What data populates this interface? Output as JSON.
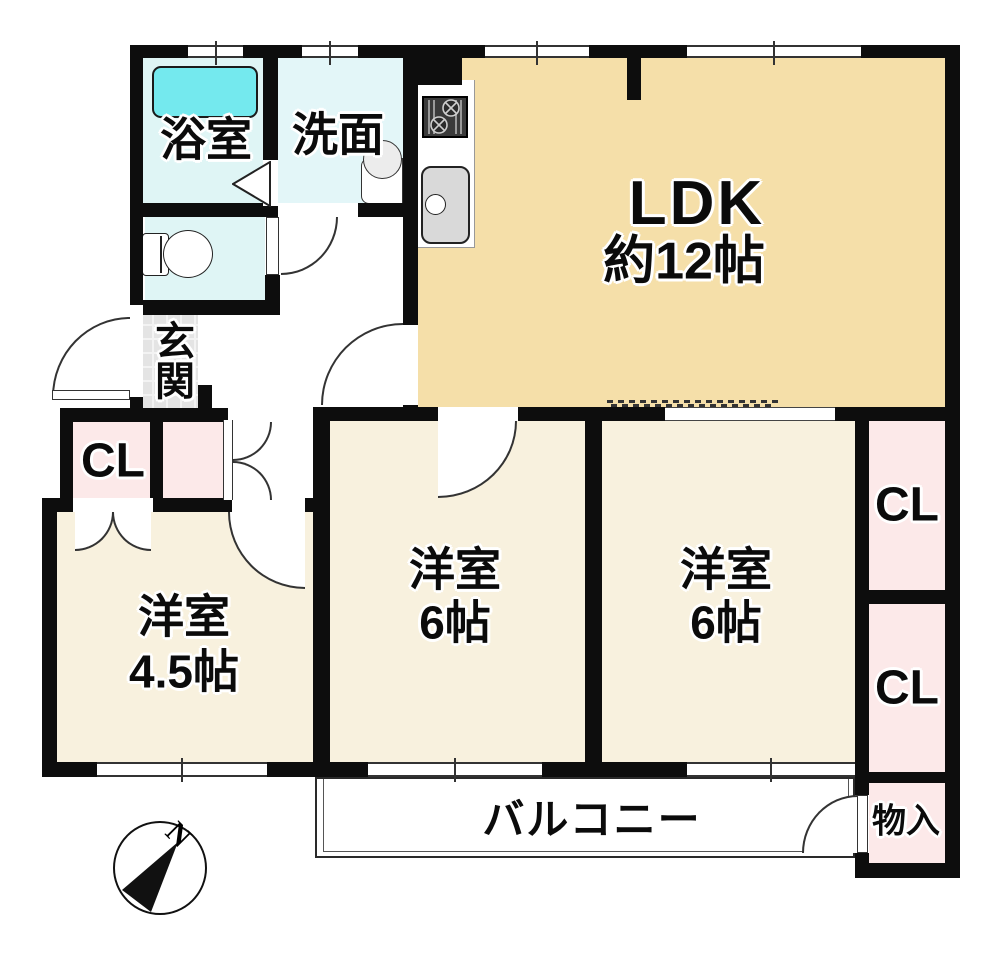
{
  "rooms": {
    "bathroom": {
      "label": "浴室"
    },
    "washroom": {
      "label": "洗面"
    },
    "ldk": {
      "label": "LDK",
      "size": "約12帖"
    },
    "genkan": {
      "label": "玄関"
    },
    "closet_left": {
      "label": "CL"
    },
    "room_small": {
      "label": "洋室",
      "size": "4.5帖"
    },
    "room_center": {
      "label": "洋室",
      "size": "6帖"
    },
    "room_right": {
      "label": "洋室",
      "size": "6帖"
    },
    "closet_right_top": {
      "label": "CL"
    },
    "closet_right_bottom": {
      "label": "CL"
    },
    "storage": {
      "label": "物入"
    },
    "balcony": {
      "label": "バルコニー"
    }
  },
  "compass": {
    "label": "N"
  },
  "colors": {
    "wall": "#0d0d0d",
    "ldk": "#F5DFA9",
    "room": "#F8F1DE",
    "closet": "#FCE9E9",
    "bath_floor": "#DFF5F5",
    "washroom_floor": "#E3F6F8",
    "bathtub": "#74E9EE",
    "genkan": "#E4E4E4",
    "fixture_gray": "#D9D9D9"
  }
}
